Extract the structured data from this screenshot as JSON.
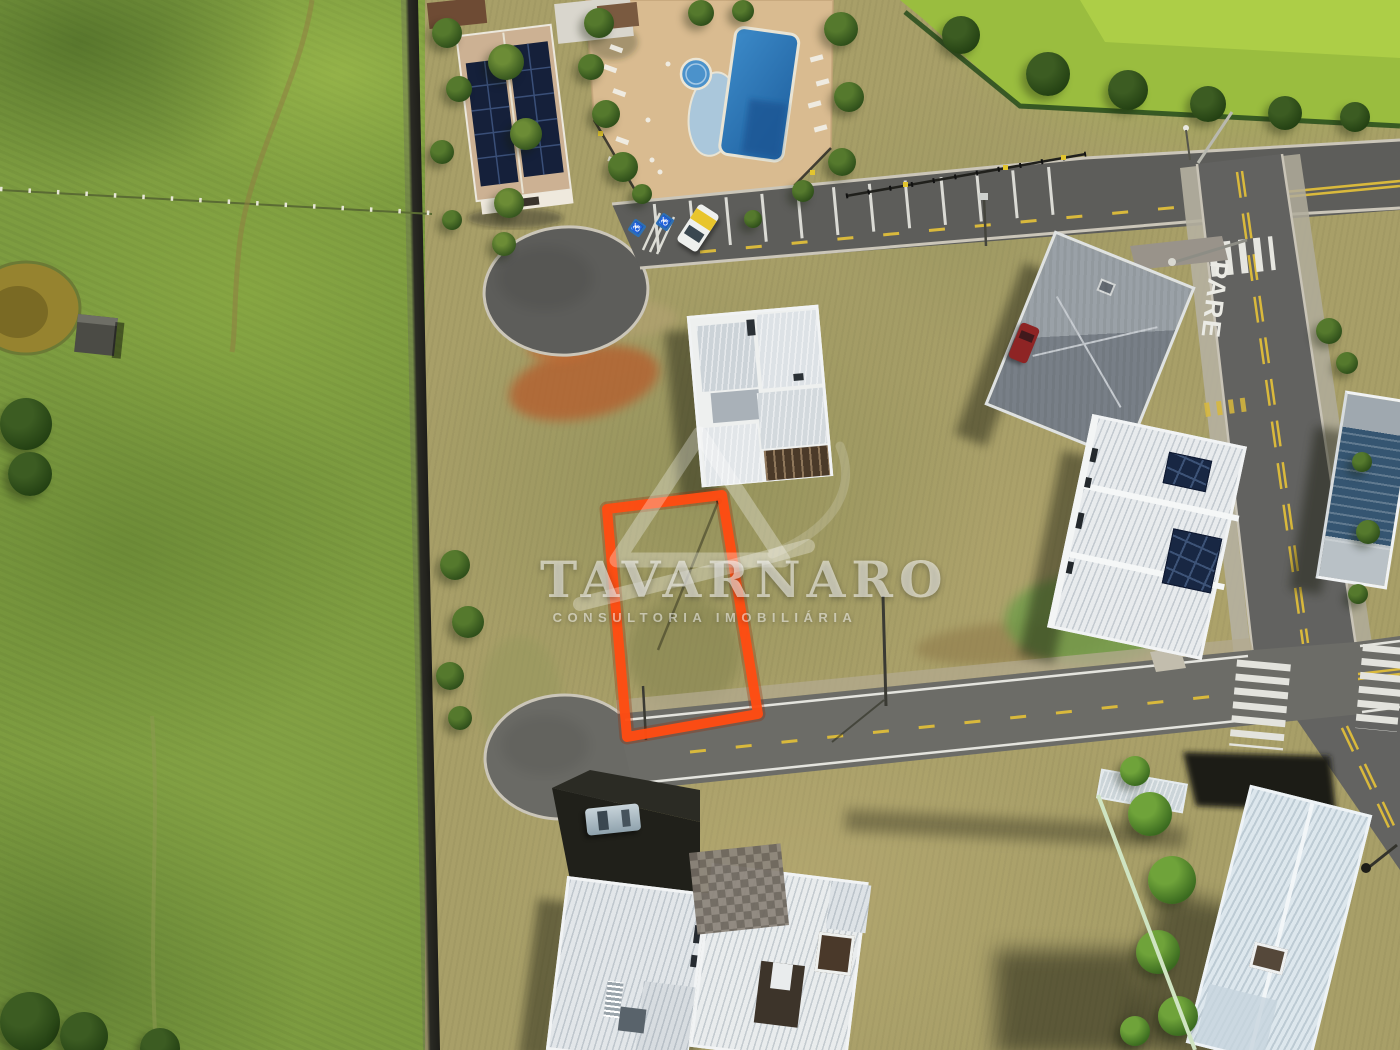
{
  "watermark": {
    "brand": "TAVARNARO",
    "tagline": "CONSULTORIA IMOBILIÁRIA"
  },
  "road_markings": {
    "stop_text": "PARE",
    "handicap_symbol": "♿"
  },
  "colors": {
    "lot_outline_orange": "#FF4C12",
    "pool_blue": "#2F7FC2",
    "pasture_green": "#7D9C40",
    "dry_grass_tan": "#A89F68",
    "asphalt_gray": "#5D5D5A",
    "solar_panel_navy": "#182743",
    "stone_deck_tan": "#D9BB90"
  }
}
